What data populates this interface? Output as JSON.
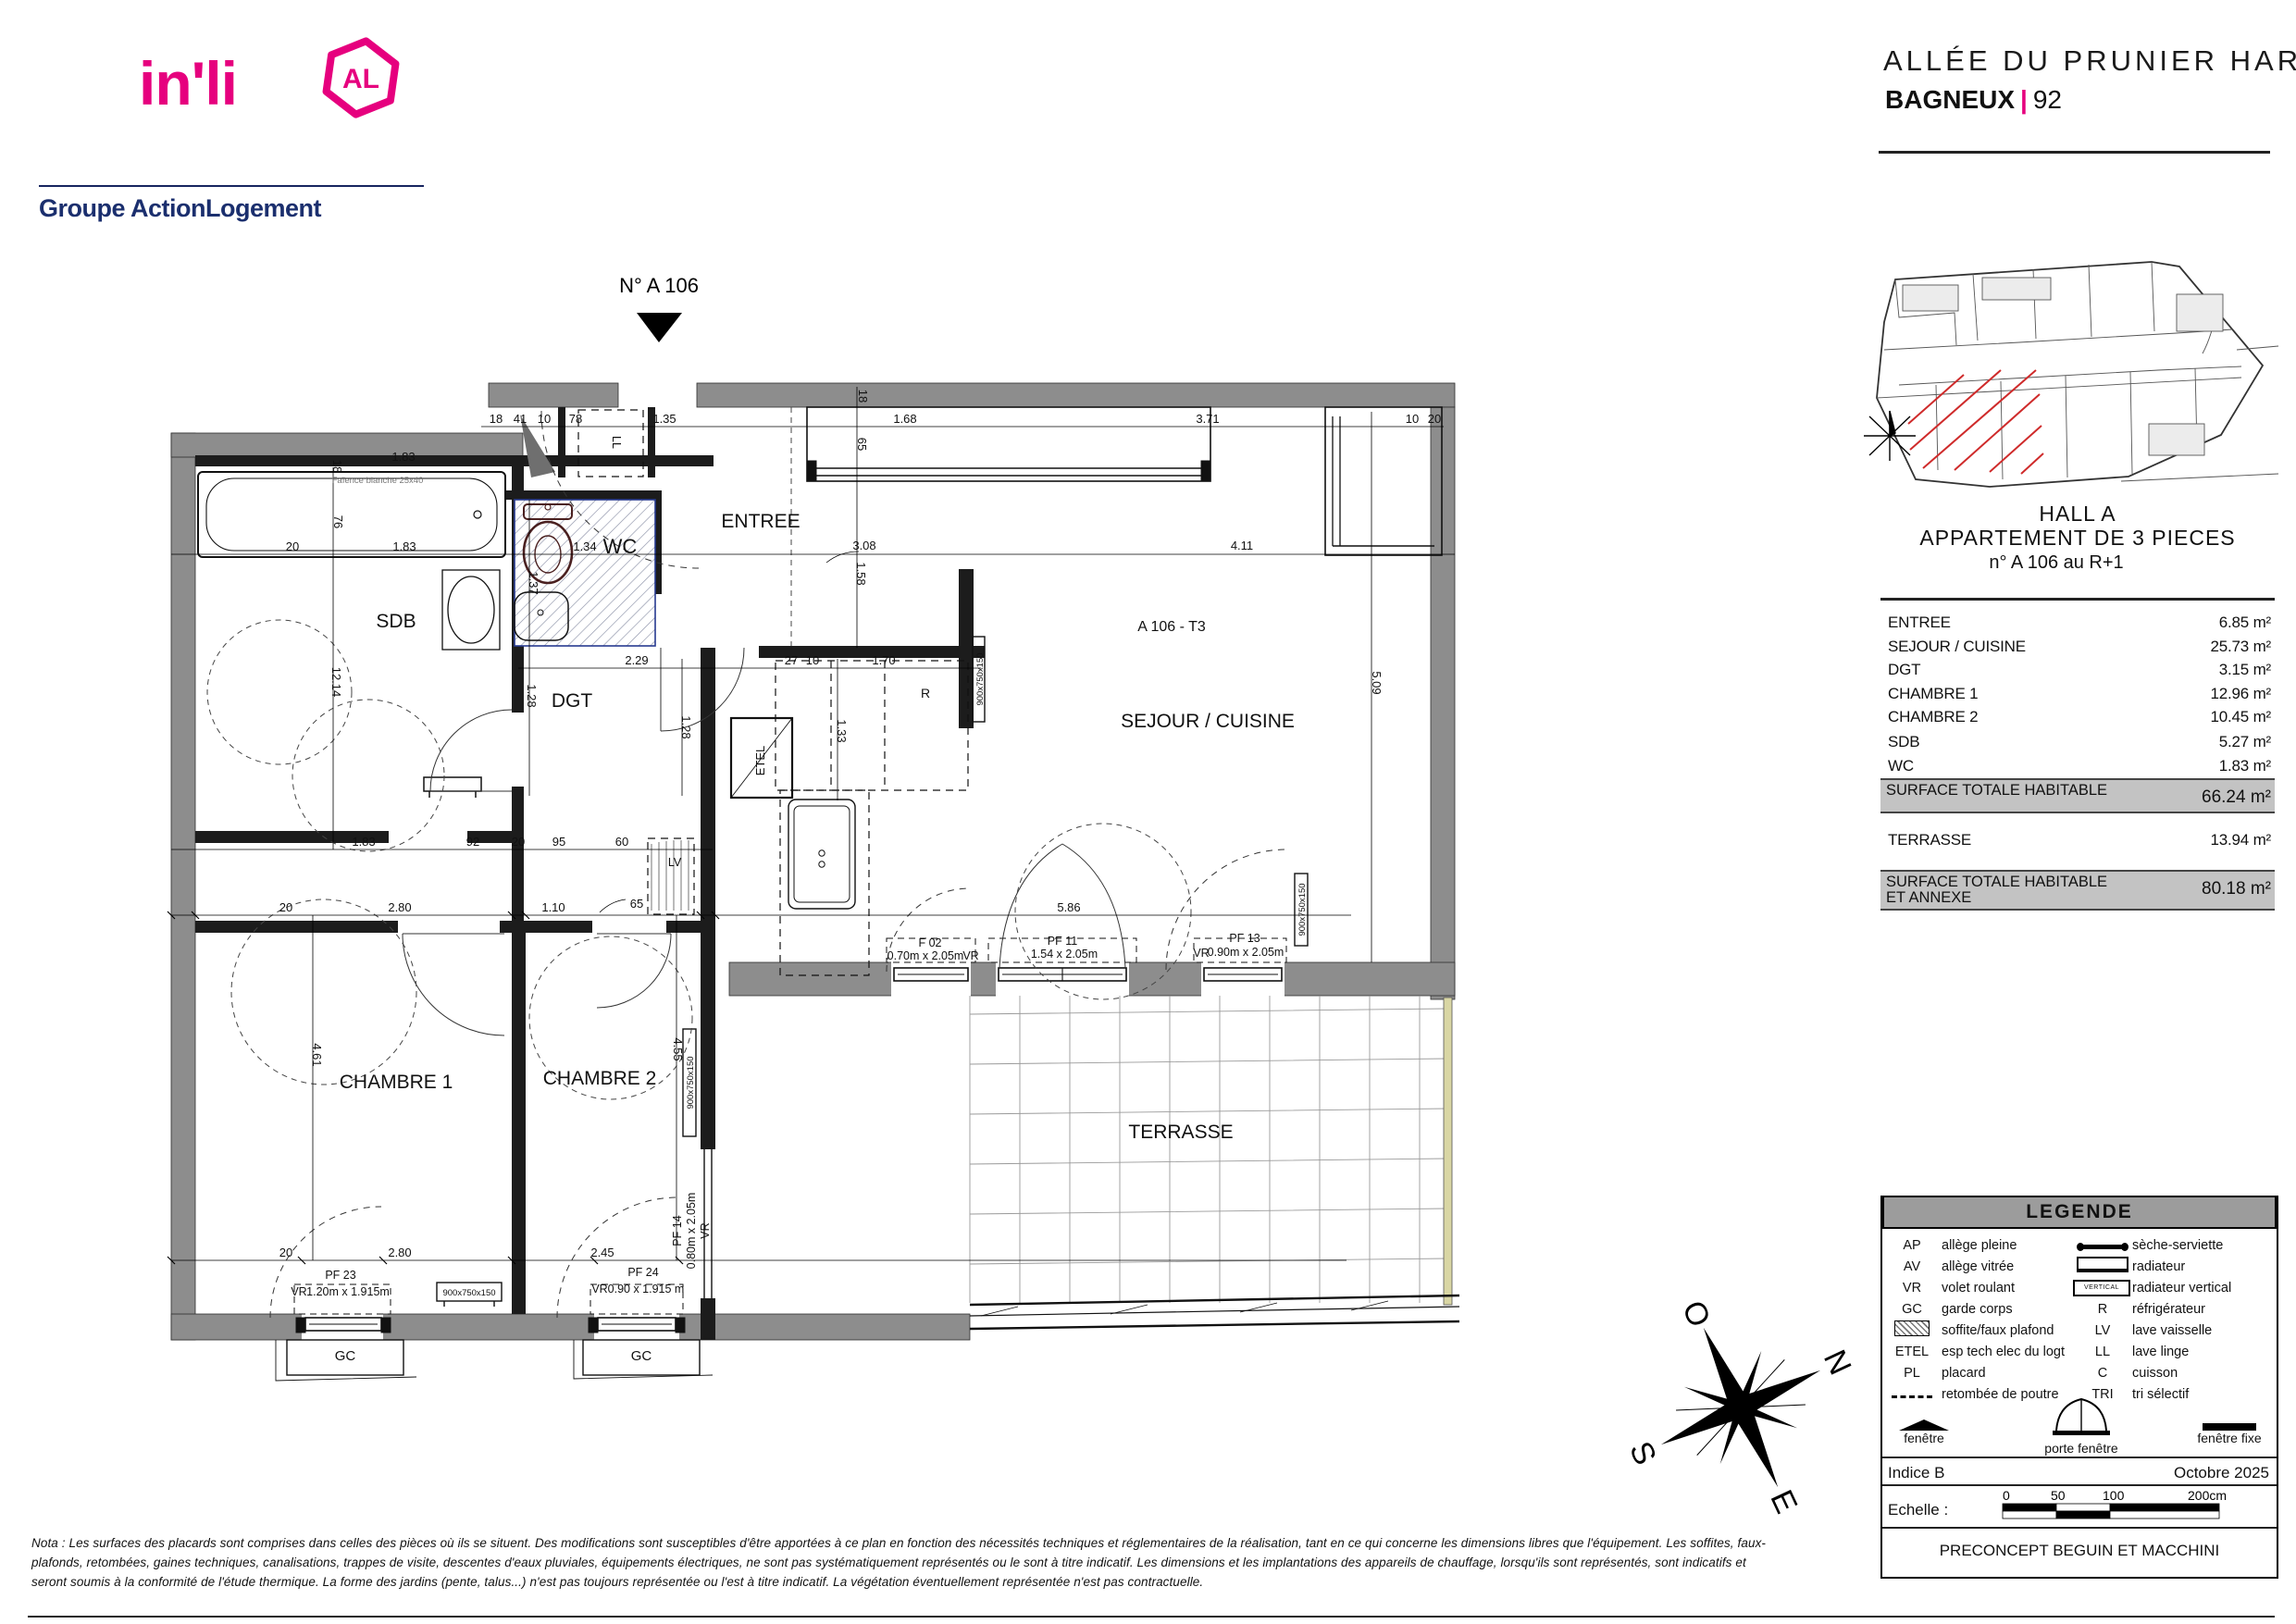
{
  "branding": {
    "logo_text": "in'li",
    "logo_badge": "AL",
    "subtitle": "Groupe ActionLogement",
    "brand_pink": "#e6007e",
    "brand_blue": "#1b2f6e"
  },
  "header": {
    "project_title": "ALLÉE DU PRUNIER HARDY",
    "city": "BAGNEUX",
    "separator": "|",
    "department": "92"
  },
  "info_panel": {
    "hall": "HALL  A",
    "apartment": "APPARTEMENT DE  3  PIECES",
    "unit": "n° A 106  au R+1",
    "areas": [
      {
        "label": "ENTREE",
        "value": "6.85 m²"
      },
      {
        "label": "SEJOUR / CUISINE",
        "value": "25.73 m²"
      },
      {
        "label": "DGT",
        "value": "3.15 m²"
      },
      {
        "label": "CHAMBRE 1",
        "value": "12.96 m²"
      },
      {
        "label": "CHAMBRE 2",
        "value": "10.45 m²"
      },
      {
        "label": "SDB",
        "value": "5.27 m²"
      },
      {
        "label": "WC",
        "value": "1.83 m²"
      }
    ],
    "total_habitable": {
      "label": "SURFACE TOTALE HABITABLE",
      "value": "66.24 m²"
    },
    "terrasse": {
      "label": "TERRASSE",
      "value": "13.94 m²"
    },
    "total_annexe": {
      "label_line1": "SURFACE TOTALE HABITABLE",
      "label_line2": "ET ANNEXE",
      "value": "80.18 m²"
    }
  },
  "plan": {
    "marker": "N° A 106",
    "rooms": {
      "entree": "ENTREE",
      "wc": "WC",
      "sdb": "SDB",
      "dgt": "DGT",
      "sejour": "SEJOUR / CUISINE",
      "tag": "A 106 - T3",
      "ch1": "CHAMBRE 1",
      "ch2": "CHAMBRE 2",
      "terrasse": "TERRASSE"
    },
    "equip": {
      "ll": "LL",
      "lv": "LV",
      "r": "R",
      "etel": "ETEL",
      "rad": "900x750x150",
      "faience": "Faïence blanche 25x40"
    },
    "win": {
      "vr": "VR",
      "gc": "GC",
      "f02": "F 02",
      "f02s": "0.70m x 2.05m",
      "pf11": "PF 11",
      "pf11s": "1.54 x 2.05m",
      "pf13": "PF 13",
      "pf13s": "0.90m x 2.05m",
      "pf14": "PF 14",
      "pf14s": "0.80m x 2.05m",
      "pf23": "PF 23",
      "pf23s": "1.20m x 1.915m",
      "pf24": "PF 24",
      "pf24s": "0.90 x 1.915 m"
    },
    "dims": {
      "t18": "18",
      "t41": "41",
      "t10": "10",
      "t78": "78",
      "t135": "1.35",
      "t168": "1.68",
      "t371": "3.71",
      "tr10": "10",
      "tr20": "20",
      "v18a": "18",
      "v65": "65",
      "v18b": "18",
      "v76": "76",
      "l20": "20",
      "a183": "1.83",
      "b183": "1.83",
      "w134": "1.34",
      "v137": "1.37",
      "v1214": "12.14",
      "d229": "2.29",
      "v128a": "1.28",
      "v128b": "1.28",
      "m308": "3.08",
      "v158": "1.58",
      "m411": "4.11",
      "k27": "27",
      "k10": "10",
      "k170": "1.70",
      "v133": "1.33",
      "v509": "5.09",
      "m183": "1.83",
      "m92": "92",
      "m20": "20",
      "m95": "95",
      "m60": "60",
      "r20": "20",
      "r280": "2.80",
      "r110": "1.10",
      "r65": "65",
      "r586": "5.86",
      "q20": "20",
      "q280": "2.80",
      "q245": "2.45",
      "v461": "4.61",
      "v455": "4.55"
    }
  },
  "legend": {
    "title": "LEGENDE",
    "vertical_text": "VERTICAL",
    "left": [
      {
        "abbr": "AP",
        "label": "allège pleine"
      },
      {
        "abbr": "AV",
        "label": "allège vitrée"
      },
      {
        "abbr": "VR",
        "label": "volet roulant"
      },
      {
        "abbr": "GC",
        "label": "garde corps"
      },
      {
        "abbr": "",
        "label": "soffite/faux plafond"
      },
      {
        "abbr": "ETEL",
        "label": "esp tech elec  du logt"
      },
      {
        "abbr": "PL",
        "label": "placard"
      },
      {
        "abbr": "",
        "label": "retombée de poutre"
      }
    ],
    "right": [
      {
        "abbr": "",
        "label": "sèche-serviette"
      },
      {
        "abbr": "",
        "label": "radiateur"
      },
      {
        "abbr": "",
        "label": "radiateur vertical"
      },
      {
        "abbr": "R",
        "label": "réfrigérateur"
      },
      {
        "abbr": "LV",
        "label": "lave vaisselle"
      },
      {
        "abbr": "LL",
        "label": "lave linge"
      },
      {
        "abbr": "C",
        "label": "cuisson"
      },
      {
        "abbr": "TRI",
        "label": "tri sélectif"
      }
    ],
    "window_symbols": [
      {
        "label": "fenêtre"
      },
      {
        "label": "porte fenêtre"
      },
      {
        "label": "fenêtre fixe"
      }
    ]
  },
  "footer_block": {
    "indice": "Indice B",
    "date": "Octobre 2025",
    "echelle_label": "Echelle :",
    "scale_ticks": [
      "0",
      "50",
      "100",
      "200cm"
    ],
    "architect": "PRECONCEPT BEGUIN ET MACCHINI"
  },
  "compass": {
    "o": "O",
    "n": "N",
    "s": "S",
    "e": "E"
  },
  "nota": "Nota : Les surfaces des placards sont comprises dans celles des pièces où ils se situent. Des modifications sont susceptibles d'être apportées à ce plan en fonction des nécessités techniques et réglementaires de la réalisation, tant en ce qui concerne les dimensions libres que l'équipement.  Les soffites, faux-plafonds, retombées, gaines techniques, canalisations, trappes de visite, descentes d'eaux pluviales, équipements électriques, ne sont pas systématiquement représentés ou le sont à titre indicatif. Les dimensions et les implantations des appareils de chauffage, lorsqu'ils sont représentés, sont indicatifs et seront soumis à la conformité de l'étude thermique. La forme des jardins (pente, talus...) n'est pas toujours représentée ou l'est à titre indicatif. La végétation éventuellement représentée n'est pas contractuelle."
}
